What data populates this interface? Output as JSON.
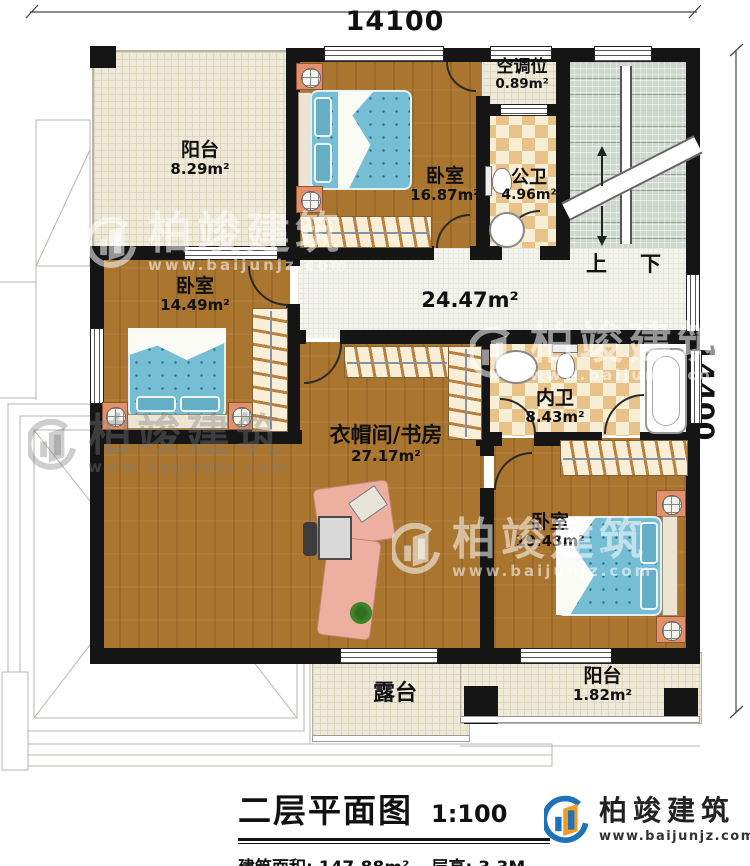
{
  "dims": {
    "top": "14100",
    "right": "14400"
  },
  "rooms": [
    {
      "id": "balcony-top",
      "name": "阳台",
      "area": "8.29m²"
    },
    {
      "id": "bedroom-top",
      "name": "卧室",
      "area": "16.87m²"
    },
    {
      "id": "ac-slot",
      "name": "空调位",
      "area": "0.89m²"
    },
    {
      "id": "bath-public",
      "name": "公卫",
      "area": "4.96m²"
    },
    {
      "id": "bedroom-left",
      "name": "卧室",
      "area": "14.49m²"
    },
    {
      "id": "study-cloak",
      "name": "衣帽间/书房",
      "area": "27.17m²"
    },
    {
      "id": "bath-inner",
      "name": "内卫",
      "area": "8.43m²"
    },
    {
      "id": "bedroom-bottom",
      "name": "卧室",
      "area": "19.43m²"
    },
    {
      "id": "terrace",
      "name": "露台",
      "area": ""
    },
    {
      "id": "balcony-bottom",
      "name": "阳台",
      "area": "1.82m²"
    }
  ],
  "hall": {
    "area": "24.47m²"
  },
  "stairs": {
    "up": "上",
    "down": "下"
  },
  "titleblock": {
    "title": "二层平面图",
    "scale": "1:100",
    "area_label": "建筑面积:",
    "area_value": "147.88m²",
    "height_label": "层高:",
    "height_value": "3.3M"
  },
  "brand": {
    "name": "柏竣建筑",
    "url": "www.baijunjz.com"
  },
  "watermark": {
    "name": "柏竣建筑",
    "url": "www.baijunjz.com"
  },
  "colors": {
    "wall": "#151515",
    "wood_floor": "#a9752f",
    "balcony_floor": "#eeead9",
    "bath_tile": "#e9c28a",
    "stair_floor": "#cfd8ce",
    "mattress": "#76bed4",
    "logo_blue": "#1e72b8",
    "logo_orange": "#f59a1d"
  }
}
